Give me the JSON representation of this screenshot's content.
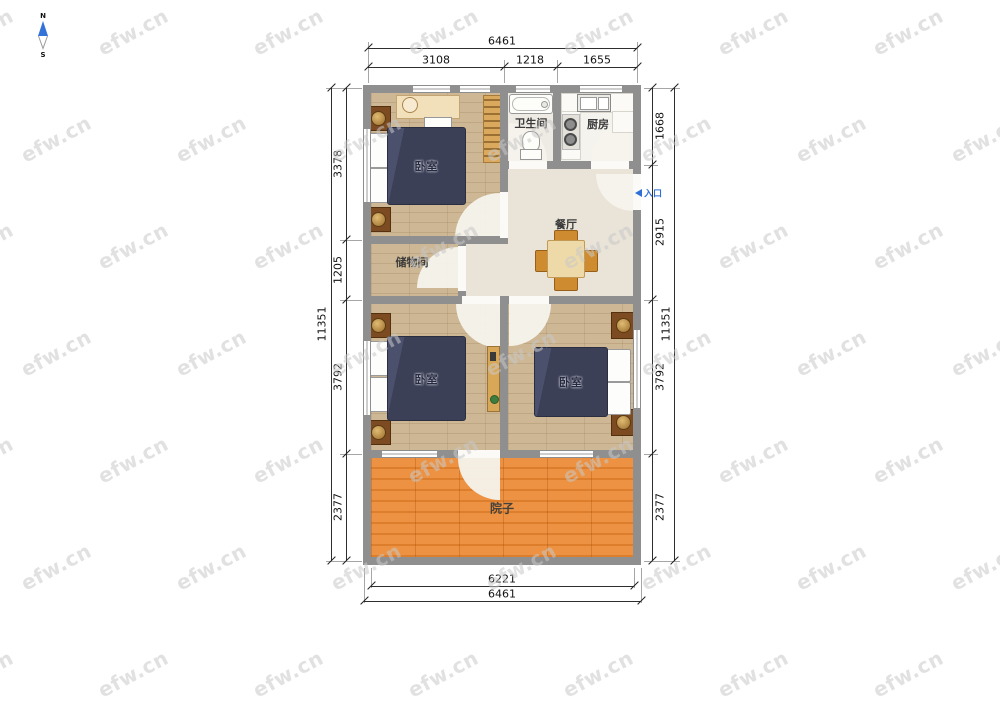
{
  "watermark": {
    "text": "efw.cn"
  },
  "compass": {
    "north": "N",
    "south": "S"
  },
  "rooms": {
    "bedroom1": "卧室",
    "bathroom": "卫生间",
    "kitchen": "厨房",
    "dining": "餐厅",
    "storage": "储物间",
    "bedroom2": "卧室",
    "bedroom3": "卧室",
    "yard": "院子",
    "entry": "入口"
  },
  "dimensions": {
    "top": {
      "total": "6461",
      "segments": [
        "3108",
        "1218",
        "1655"
      ]
    },
    "bottom": {
      "inner": "6221",
      "outer": "6461"
    },
    "left": {
      "total": "11351",
      "segments": [
        "3378",
        "1205",
        "3792",
        "2377"
      ]
    },
    "right": {
      "total": "11351",
      "segments": [
        "1668",
        "2915",
        "3792",
        "2377"
      ]
    }
  },
  "colors": {
    "wall": "#8f8f8f",
    "wood_floor": "#c8b18e",
    "deck": "#e88a38",
    "bed": "#3c4057",
    "accent_blue": "#2f6fd6",
    "dim_line": "#2e2e2e"
  }
}
